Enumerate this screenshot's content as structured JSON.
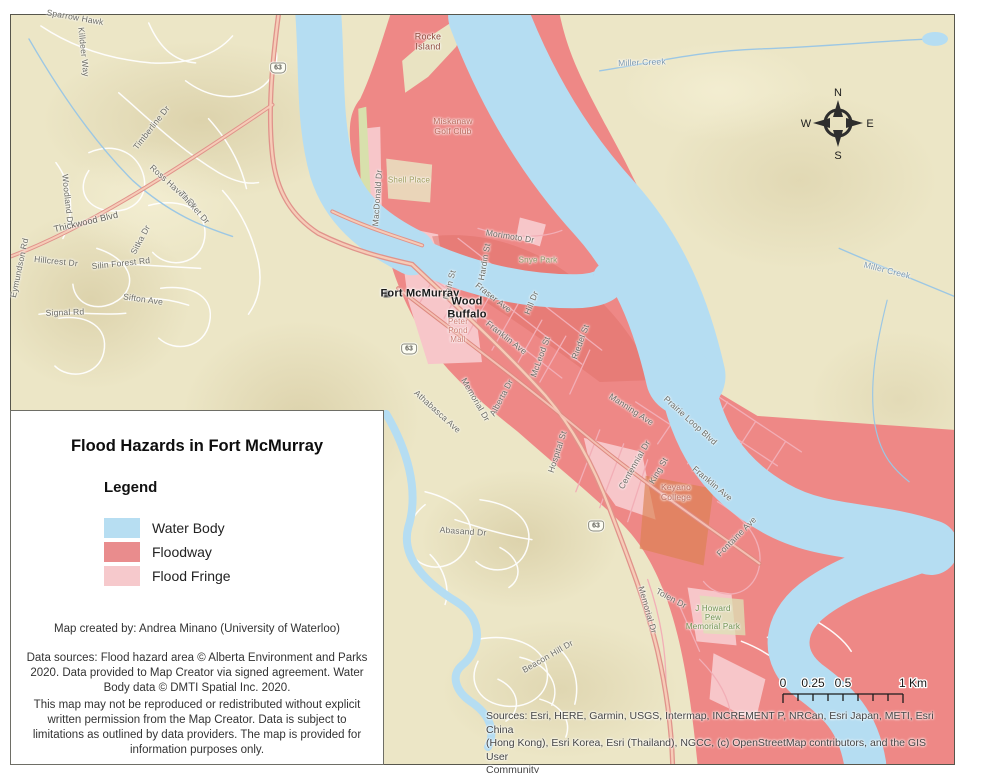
{
  "map": {
    "legend": {
      "title": "Flood Hazards in Fort McMurray",
      "heading": "Legend",
      "items": [
        {
          "label": "Water Body",
          "color": "#b7def2"
        },
        {
          "label": "Floodway",
          "color": "#e98c8d"
        },
        {
          "label": "Flood Fringe",
          "color": "#f6c9cc"
        }
      ],
      "created_by": "Map created by: Andrea Minano (University of Waterloo)",
      "data_sources": "Data sources: Flood hazard area © Alberta Environment and Parks\n2020. Data provided to Map Creator via signed agreement. Water\nBody data © DMTI Spatial Inc. 2020.",
      "disclaimer": "This map may not be reproduced or redistributed without explicit\nwritten permission from the Map Creator. Data is subject to\nlimitations as outlined by data providers. The map is provided for\ninformation purposes only."
    },
    "attribution": "Sources: Esri, HERE, Garmin, USGS, Intermap, INCREMENT P, NRCan, Esri Japan, METI, Esri China\n(Hong Kong), Esri Korea, Esri (Thailand), NGCC, (c) OpenStreetMap contributors, and the GIS User\nCommunity",
    "scalebar": {
      "labels": [
        "0",
        "0.25",
        "0.5",
        "1 Km"
      ]
    },
    "compass": {
      "n": "N",
      "e": "E",
      "s": "S",
      "w": "W"
    },
    "colors": {
      "land": "#ece6c6",
      "water": "#b5ddf2",
      "floodway": "#ee8886",
      "flood_fringe": "#f7c6c9",
      "highway": "#e0938b",
      "frame_border": "#57564c"
    },
    "shields": [
      {
        "text": "63"
      },
      {
        "text": "63"
      },
      {
        "text": "63"
      }
    ],
    "labels": [
      {
        "text": "Sparrow Hawk"
      },
      {
        "text": "Killdeer Way"
      },
      {
        "text": "Timberline Dr"
      },
      {
        "text": "Ross Haven Dr"
      },
      {
        "text": "Thicket Dr"
      },
      {
        "text": "Woodland Dr"
      },
      {
        "text": "Thickwood Blvd"
      },
      {
        "text": "Eymundson Rd"
      },
      {
        "text": "Sitka Dr"
      },
      {
        "text": "Silin Forest Rd"
      },
      {
        "text": "Hillcrest Dr"
      },
      {
        "text": "Signal Rd"
      },
      {
        "text": "Sifton Ave"
      },
      {
        "text": "Rocke\nIsland"
      },
      {
        "text": "Miskanaw\nGolf Club"
      },
      {
        "text": "Shell Place"
      },
      {
        "text": "MacDonald Dr"
      },
      {
        "text": "Miller Creek"
      },
      {
        "text": "Miller Creek"
      },
      {
        "text": "Morimoto Dr"
      },
      {
        "text": "Snye Park"
      },
      {
        "text": "Hardin St"
      },
      {
        "text": "Main St"
      },
      {
        "text": "Fort McMurray"
      },
      {
        "text": "Wood\nBuffalo"
      },
      {
        "text": "Fraser Ave"
      },
      {
        "text": "Hill Dr"
      },
      {
        "text": "Franklin Ave"
      },
      {
        "text": "McLeod St"
      },
      {
        "text": "Riedel St"
      },
      {
        "text": "Peter\nPond\nMall"
      },
      {
        "text": "Memorial Dr"
      },
      {
        "text": "Alberta Dr"
      },
      {
        "text": "Athabasca Ave"
      },
      {
        "text": "Abasand Dr"
      },
      {
        "text": "Hospital St"
      },
      {
        "text": "Manning Ave"
      },
      {
        "text": "Prairie Loop Blvd"
      },
      {
        "text": "Centennial Dr"
      },
      {
        "text": "King St"
      },
      {
        "text": "Franklin Ave"
      },
      {
        "text": "Keyano\nCollege"
      },
      {
        "text": "Fontaine Ave"
      },
      {
        "text": "Beacon Hill Dr"
      },
      {
        "text": "Memorial Dr"
      },
      {
        "text": "Tolen Dr"
      },
      {
        "text": "J Howard\nPew\nMemorial Park"
      }
    ]
  }
}
